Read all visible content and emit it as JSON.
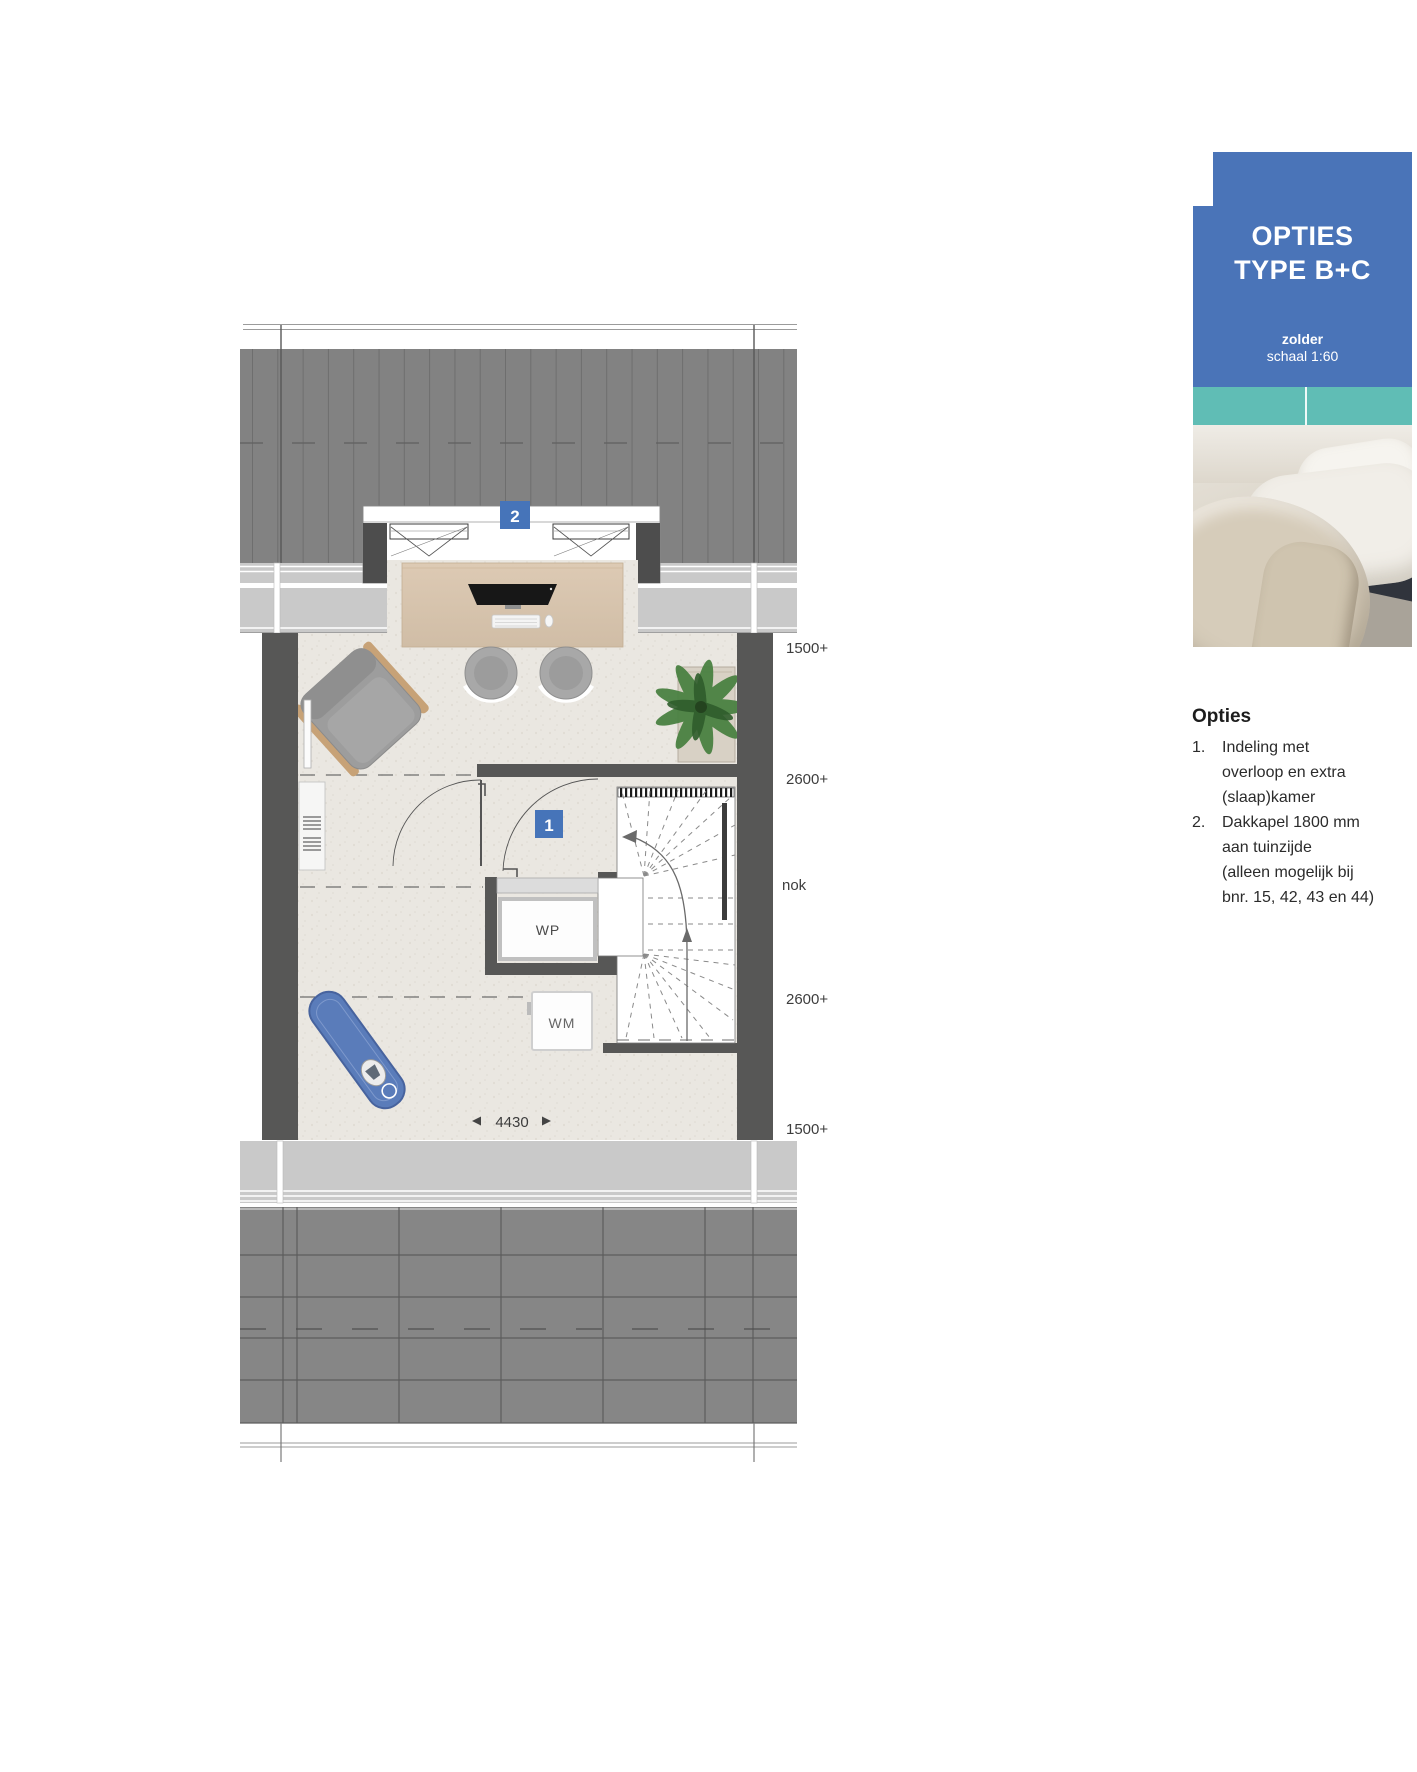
{
  "colors": {
    "brand_blue": "#4a74b8",
    "teal": "#60bdb5",
    "roof_gray": "#828282",
    "wall_gray": "#575756"
  },
  "card": {
    "title_line1": "OPTIES",
    "title_line2": "TYPE B+C",
    "plan_name": "zolder",
    "plan_scale": "schaal 1:60"
  },
  "options": {
    "heading": "Opties",
    "items": [
      {
        "num": "1.",
        "lines": [
          "Indeling met",
          "overloop en extra",
          "(slaap)kamer"
        ]
      },
      {
        "num": "2.",
        "lines": [
          "Dakkapel 1800 mm",
          "aan tuinzijde",
          "(alleen mogelijk bij",
          "bnr. 15, 42, 43 en 44)"
        ]
      }
    ]
  },
  "plan": {
    "option_badges": {
      "layout": "1",
      "dormer": "2"
    },
    "appliances": {
      "heat_pump": "WP",
      "washing_machine": "WM"
    },
    "height_labels": [
      "1500+",
      "2600+",
      "nok",
      "2600+",
      "1500+"
    ],
    "width_dimension": "4430"
  }
}
